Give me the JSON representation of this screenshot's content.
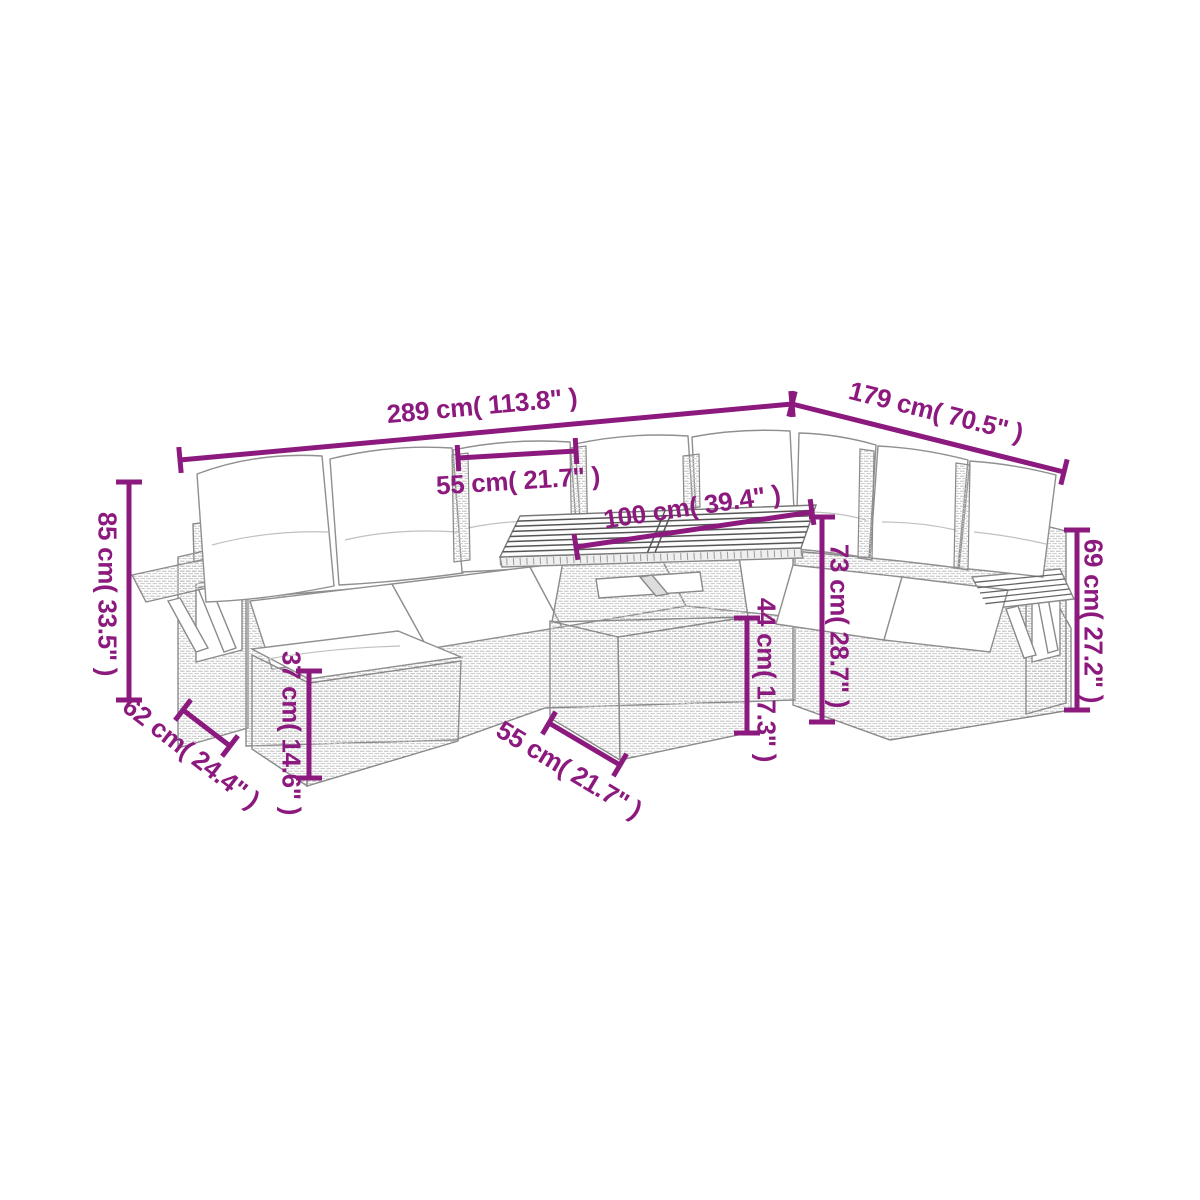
{
  "diagram": {
    "background": "#ffffff",
    "accent_color": "#8C1A7E",
    "line_art_color": "#8a8a8a",
    "dimensions": [
      {
        "id": "total-width",
        "label": "289 cm( 113.8\" )",
        "line": {
          "x1": 180,
          "y1": 460,
          "x2": 792,
          "y2": 404
        },
        "text": {
          "x": 482,
          "y": 406,
          "rotate": -5.2
        }
      },
      {
        "id": "total-depth",
        "label": "179 cm( 70.5\" )",
        "line": {
          "x1": 792,
          "y1": 404,
          "x2": 1064,
          "y2": 472
        },
        "text": {
          "x": 936,
          "y": 412,
          "rotate": 14.1
        }
      },
      {
        "id": "seat-width",
        "label": "55 cm( 21.7\" )",
        "line": {
          "x1": 458,
          "y1": 458,
          "x2": 576,
          "y2": 451
        },
        "text": {
          "x": 518,
          "y": 481,
          "rotate": -3.5
        }
      },
      {
        "id": "table-length",
        "label": "100 cm( 39.4\" )",
        "line": {
          "x1": 576,
          "y1": 547,
          "x2": 812,
          "y2": 512
        },
        "text": {
          "x": 692,
          "y": 507,
          "rotate": -8.4
        }
      },
      {
        "id": "back-height",
        "label": "85 cm( 33.5\" )",
        "line": {
          "x1": 129,
          "y1": 482,
          "x2": 129,
          "y2": 700
        },
        "text": {
          "x": 107,
          "y": 594,
          "rotate": 90
        }
      },
      {
        "id": "seat-depth",
        "label": "62 cm( 24.4\" )",
        "line": {
          "x1": 183,
          "y1": 710,
          "x2": 230,
          "y2": 746
        },
        "text": {
          "x": 191,
          "y": 753,
          "rotate": 37.5
        }
      },
      {
        "id": "stool-height",
        "label": "37 cm( 14.6\" )",
        "line": {
          "x1": 309,
          "y1": 671,
          "x2": 309,
          "y2": 778
        },
        "text": {
          "x": 291,
          "y": 733,
          "rotate": 90
        }
      },
      {
        "id": "table-width",
        "label": "55 cm( 21.7\" )",
        "line": {
          "x1": 549,
          "y1": 723,
          "x2": 620,
          "y2": 765
        },
        "text": {
          "x": 569,
          "y": 770,
          "rotate": 31
        }
      },
      {
        "id": "table-base-height",
        "label": "44 cm( 17.3\" )",
        "line": {
          "x1": 747,
          "y1": 618,
          "x2": 747,
          "y2": 733
        },
        "text": {
          "x": 766,
          "y": 680,
          "rotate": 90
        }
      },
      {
        "id": "table-height",
        "label": "73 cm( 28.7\" )",
        "line": {
          "x1": 822,
          "y1": 517,
          "x2": 822,
          "y2": 722
        },
        "text": {
          "x": 839,
          "y": 626,
          "rotate": 90
        }
      },
      {
        "id": "arm-height",
        "label": "69 cm( 27.2\" )",
        "line": {
          "x1": 1077,
          "y1": 530,
          "x2": 1077,
          "y2": 710
        },
        "text": {
          "x": 1093,
          "y": 621,
          "rotate": 90
        }
      }
    ]
  }
}
